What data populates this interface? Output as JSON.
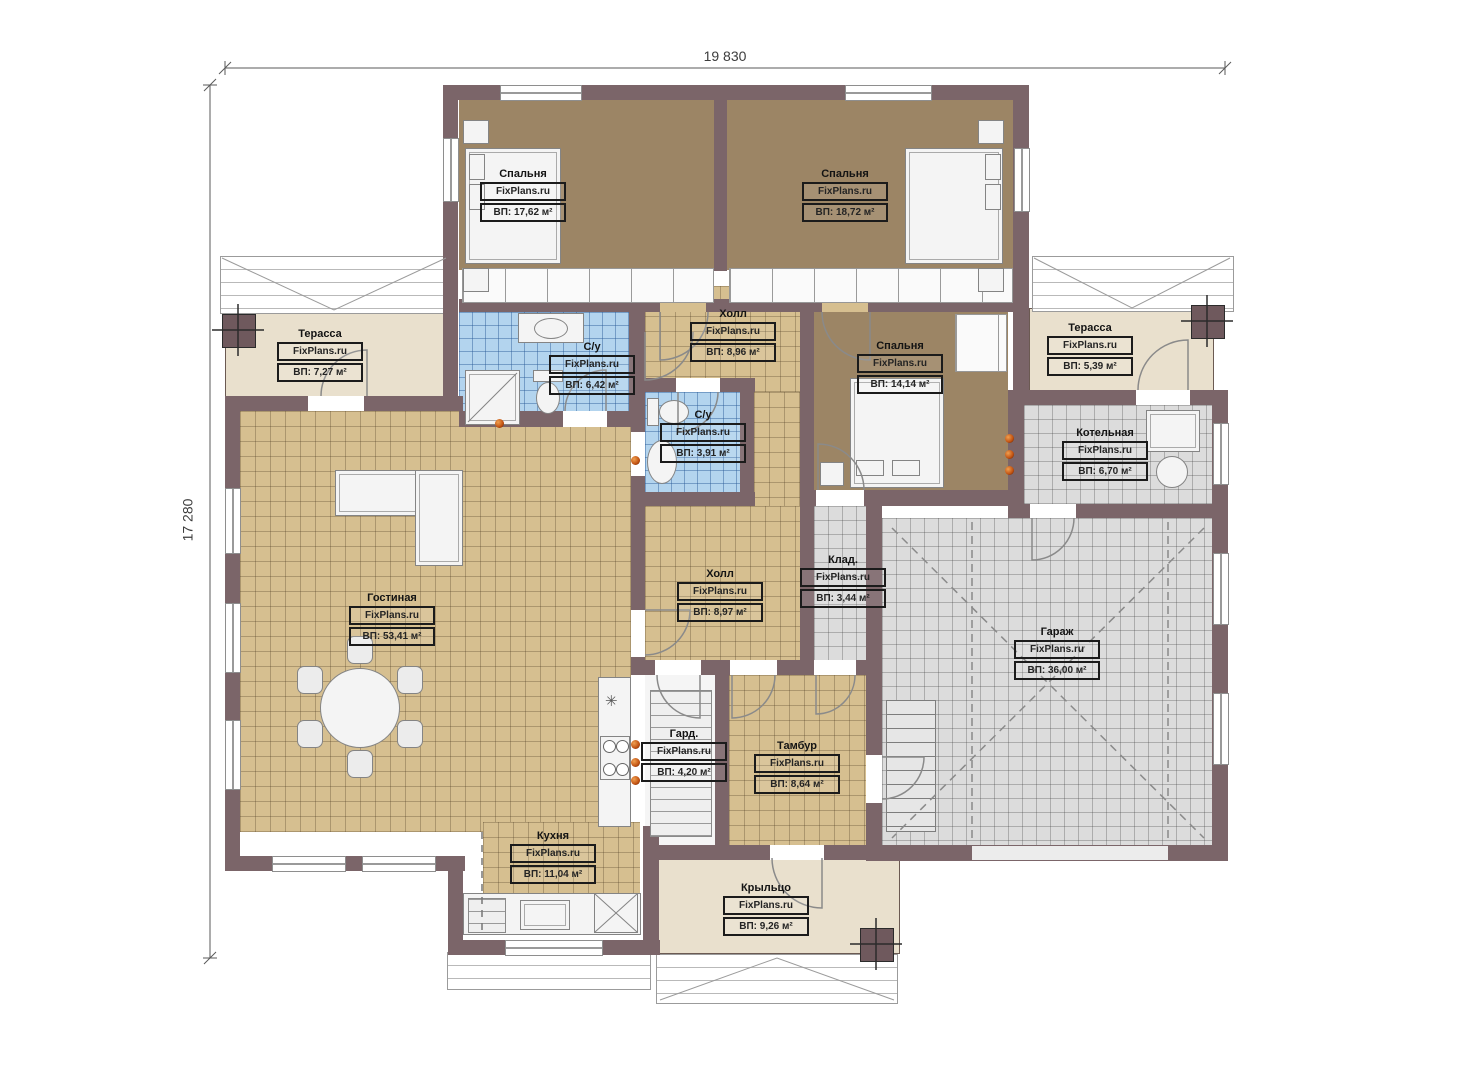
{
  "plan": {
    "watermark": "FixPlans.ru",
    "kitchen_marker": "✳",
    "dimensions": {
      "width_label": "19 830",
      "height_label": "17 280"
    },
    "colors": {
      "wall": "#7b6569",
      "bedroom_floor": "#9c8565",
      "tile_tan": "#d6bf90",
      "tile_blue": "#b3d4ee",
      "tile_gray": "#dcdcdc",
      "terrace_beige": "#e9e0cd",
      "vent_dot": "#c05010"
    }
  },
  "rooms": [
    {
      "name": "Спальня",
      "area": "ВП: 17,62 м²"
    },
    {
      "name": "Спальня",
      "area": "ВП: 18,72 м²"
    },
    {
      "name": "Терасса",
      "area": "ВП: 7,27 м²"
    },
    {
      "name": "С/у",
      "area": "ВП: 6,42 м²"
    },
    {
      "name": "Холл",
      "area": "ВП: 8,96 м²"
    },
    {
      "name": "Спальня",
      "area": "ВП: 14,14 м²"
    },
    {
      "name": "Терасса",
      "area": "ВП: 5,39 м²"
    },
    {
      "name": "Котельная",
      "area": "ВП: 6,70 м²"
    },
    {
      "name": "С/у",
      "area": "ВП: 3,91 м²"
    },
    {
      "name": "Гостиная",
      "area": "ВП: 53,41 м²"
    },
    {
      "name": "Холл",
      "area": "ВП: 8,97 м²"
    },
    {
      "name": "Клад.",
      "area": "ВП: 3,44 м²"
    },
    {
      "name": "Гараж",
      "area": "ВП: 36,00 м²"
    },
    {
      "name": "Гард.",
      "area": "ВП: 4,20 м²"
    },
    {
      "name": "Тамбур",
      "area": "ВП: 8,64 м²"
    },
    {
      "name": "Кухня",
      "area": "ВП: 11,04 м²"
    },
    {
      "name": "Крыльцо",
      "area": "ВП: 9,26 м²"
    }
  ]
}
